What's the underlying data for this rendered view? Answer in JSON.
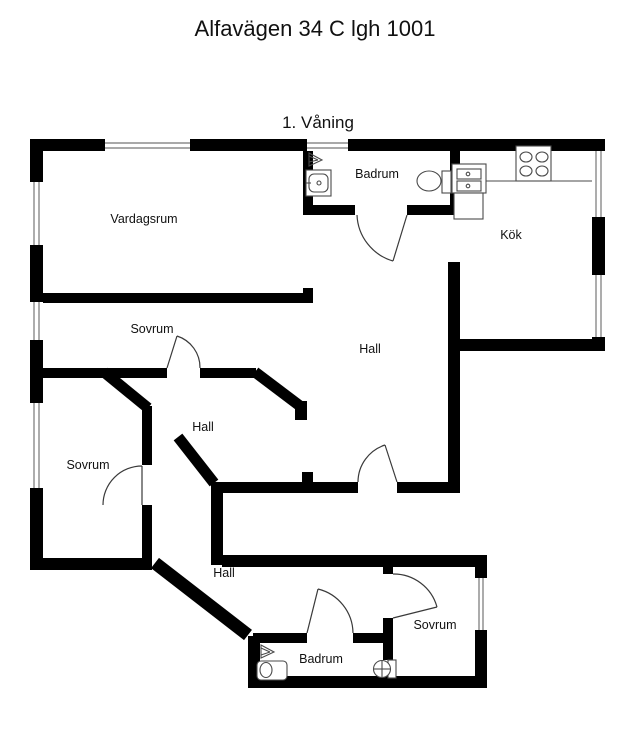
{
  "page": {
    "title": "Alfavägen 34 C lgh 1001",
    "floor_label": "1. Våning"
  },
  "colors": {
    "wall": "#000000",
    "background": "#ffffff",
    "text": "#111111",
    "fixture_outline": "#4a4a4a"
  },
  "rooms": {
    "vardagsrum": {
      "label": "Vardagsrum"
    },
    "badrum_top": {
      "label": "Badrum"
    },
    "kok": {
      "label": "Kök"
    },
    "sovrum_top": {
      "label": "Sovrum"
    },
    "hall_main": {
      "label": "Hall"
    },
    "hall_mid": {
      "label": "Hall"
    },
    "sovrum_left": {
      "label": "Sovrum"
    },
    "hall_lower": {
      "label": "Hall"
    },
    "sovrum_bottom": {
      "label": "Sovrum"
    },
    "badrum_bottom": {
      "label": "Badrum"
    }
  },
  "fixture_icons": [
    "shower-icon",
    "washbasin-icon",
    "toilet-icon",
    "stove-icon",
    "kitchen-sink-cabinet-icon",
    "window-icon",
    "door-arc-icon"
  ]
}
